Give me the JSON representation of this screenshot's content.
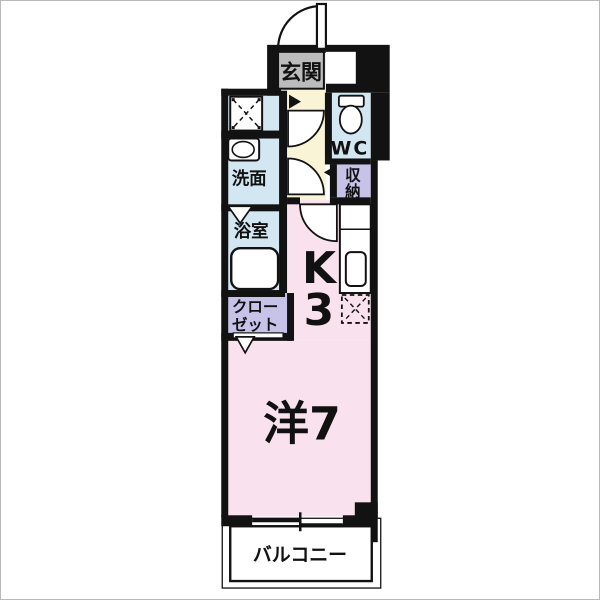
{
  "plan": {
    "type": "japanese-apartment-floor-plan",
    "rooms": {
      "genkan": "玄関",
      "wc": "WC",
      "senmen": "洗面",
      "shunou_line1": "収",
      "shunou_line2": "納",
      "yokushitsu": "浴室",
      "closet_line1": "クロー",
      "closet_line2": "ゼット",
      "kitchen_line1": "K",
      "kitchen_line2": "3",
      "western_room": "洋7",
      "balcony": "バルコニー"
    },
    "colors": {
      "wall": "#121212",
      "wet_blue": "#d2e7f2",
      "cream": "#f8f4d5",
      "pink": "#f9e2ee",
      "purple": "#c7c3e8",
      "gray": "#bcbcbc",
      "background": "#ffffff"
    }
  }
}
